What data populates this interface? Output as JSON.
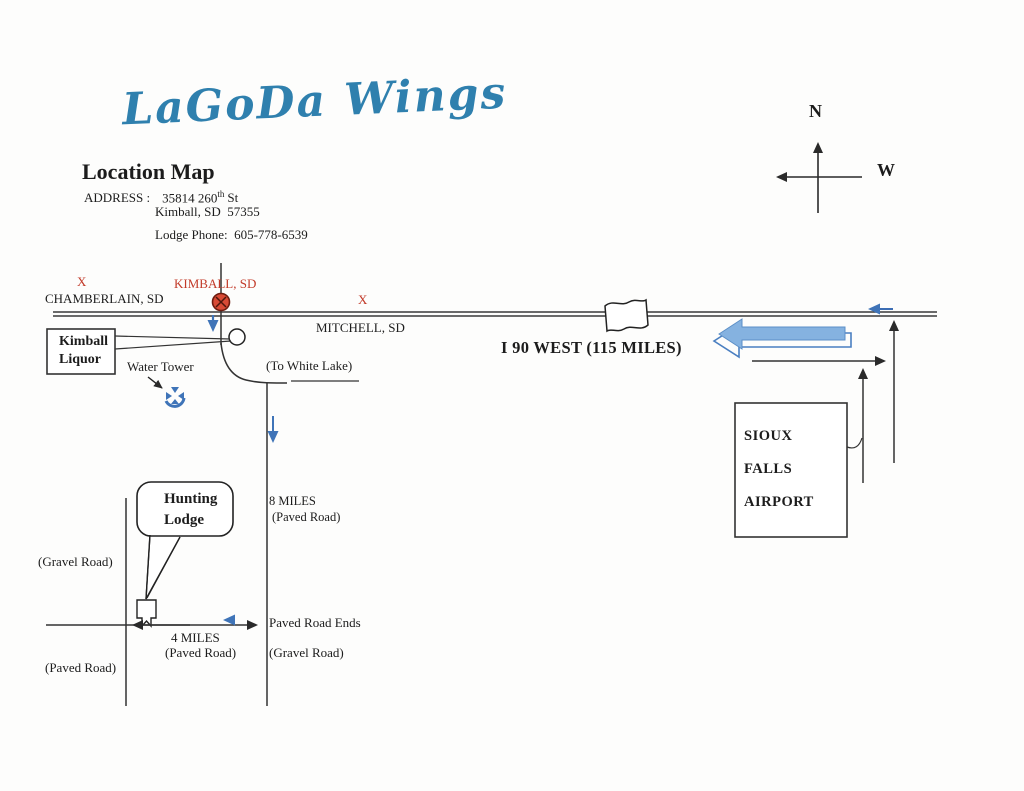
{
  "page": {
    "title_script": "LaGoDa Wings"
  },
  "header": {
    "heading": "Location Map",
    "address_label": "ADDRESS :",
    "address_street_base": "35814 260",
    "address_street_sup": "th",
    "address_street_suffix": "St",
    "address_city": "Kimball, SD  57355",
    "phone": "Lodge Phone:  605-778-6539"
  },
  "compass": {
    "north_label": "N",
    "west_label": "W"
  },
  "road_labels": {
    "chamberlain_x": "X",
    "chamberlain": "CHAMBERLAIN, SD",
    "kimball": "KIMBALL, SD",
    "mitchell_x": "X",
    "mitchell": "MITCHELL, SD",
    "i90_west": "I 90 WEST (115 MILES)"
  },
  "landmarks": {
    "kimball_liquor_line1": "Kimball",
    "kimball_liquor_line2": "Liquor",
    "water_tower": "Water Tower",
    "to_white_lake": "(To White Lake)",
    "hunting_lodge_line1": "Hunting",
    "hunting_lodge_line2": "Lodge",
    "airport_line1": "SIOUX",
    "airport_line2": "FALLS",
    "airport_line3": "AIRPORT"
  },
  "route_labels": {
    "miles8": "8 MILES",
    "miles8_sub": "(Paved Road)",
    "gravel_road_west": "(Gravel Road)",
    "paved_road_west": "(Paved Road)",
    "miles4": "4 MILES",
    "miles4_sub": "(Paved Road)",
    "paved_road_ends": "Paved Road Ends",
    "gravel_road_south": "(Gravel Road)"
  },
  "colors": {
    "title_blue": "#2f80ae",
    "label_red": "#c23b2a",
    "marker_red_fill": "#d84a35",
    "arrow_blue": "#3f74b8",
    "big_arrow_fill": "#85b2e0",
    "big_arrow_outline": "#4a7fc1",
    "line_ink": "#2e2e2e"
  }
}
